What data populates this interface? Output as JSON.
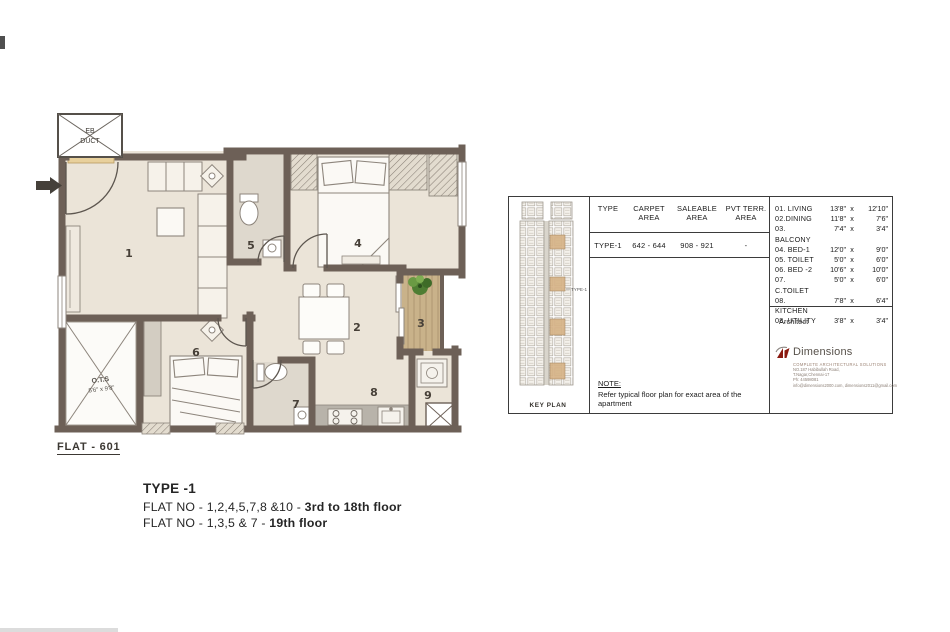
{
  "plan": {
    "flat_label": "FLAT - 601",
    "eb_duct_line1": "EB",
    "eb_duct_line2": "DUCT",
    "ots_label": "O.T.S",
    "ots_dim": "5'6\" x 9'8\"",
    "numbers": {
      "living": "1",
      "dining": "2",
      "balcony": "3",
      "bed1": "4",
      "toilet": "5",
      "bed2": "6",
      "ctoilet": "7",
      "kitchen": "8",
      "utility": "9"
    }
  },
  "type_block": {
    "title": "TYPE -1",
    "line1_prefix": "FLAT NO - 1,2,4,5,7,8 &10 - ",
    "line1_bold": "3rd to 18th floor",
    "line2_prefix": "FLAT NO - 1,3,5 & 7 - ",
    "line2_bold": "19th floor"
  },
  "panel": {
    "key_plan": {
      "callout": "TYPE-1",
      "label": "KEY PLAN"
    },
    "area_table": {
      "headers": [
        {
          "t": "TYPE",
          "b": ""
        },
        {
          "t": "CARPET",
          "b": "AREA"
        },
        {
          "t": "SALEABLE",
          "b": "AREA"
        },
        {
          "t": "PVT TERR.",
          "b": "AREA"
        }
      ],
      "row": {
        "type": "TYPE-1",
        "carpet": "642 - 644",
        "saleable": "908 - 921",
        "pvt": "-"
      }
    },
    "dim_sep": "x",
    "rooms": [
      {
        "label": "01. LIVING",
        "d1": "13'8\"",
        "d2": "12'10\""
      },
      {
        "label": "02.DINING",
        "d1": "11'8\"",
        "d2": "7'6\""
      },
      {
        "label": "03. BALCONY",
        "d1": "7'4\"",
        "d2": "3'4\""
      },
      {
        "label": "04. BED-1",
        "d1": "12'0\"",
        "d2": "9'0\""
      },
      {
        "label": "05. TOILET",
        "d1": "5'0\"",
        "d2": "6'0\""
      },
      {
        "label": "06. BED -2",
        "d1": "10'6\"",
        "d2": "10'0\""
      },
      {
        "label": "07. C.TOILET",
        "d1": "5'0\"",
        "d2": "6'0\""
      },
      {
        "label": "08. KITCHEN",
        "d1": "7'8\"",
        "d2": "6'4\""
      },
      {
        "label": "08. UTILITY",
        "d1": "3'8\"",
        "d2": "3'4\""
      }
    ],
    "note_title": "NOTE:",
    "note_body": "Refer typical floor plan for exact area of the apartment",
    "architect": {
      "label": "Architect",
      "firm": "Dimensions",
      "tagline": "COMPLETE ARCHITECTURAL SOLUTIONS",
      "addr1": "NO.187 Habibullah Road,",
      "addr2": "T.Nagar,Chennai-17",
      "phone": "Ph: 44598081",
      "email": "info@dimensions2000.com, dimensions2011@gmail.com"
    }
  },
  "colors": {
    "wall": "#6d6057",
    "floor": "#ebe4d8",
    "balcony_wood": "#c9b28a",
    "logo_maroon": "#8b1a10",
    "keyplan_highlight": "#d6b285"
  }
}
